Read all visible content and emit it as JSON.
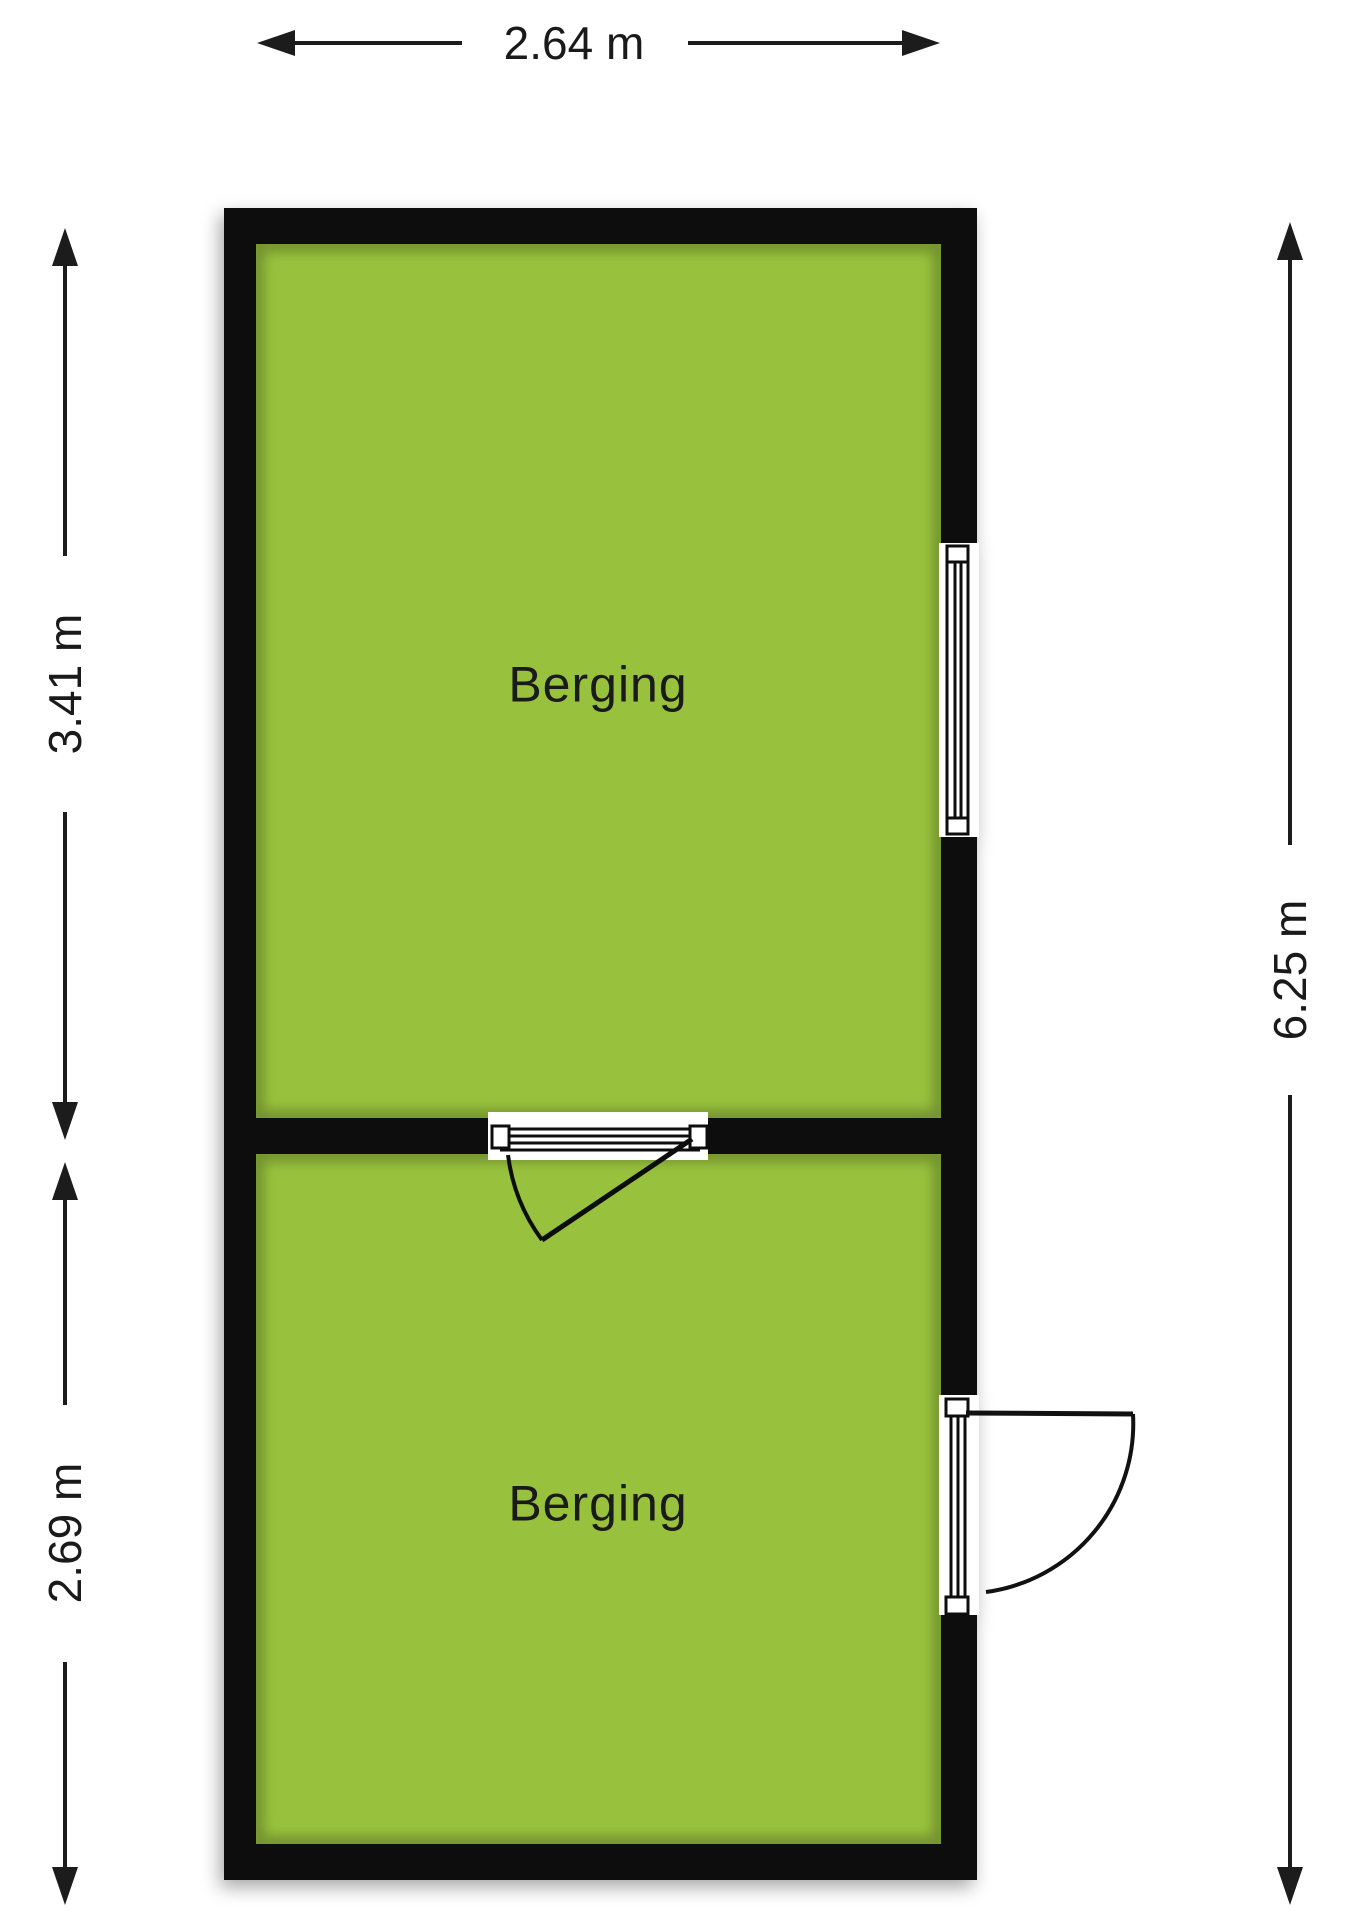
{
  "floorplan": {
    "rooms": [
      {
        "label": "Berging"
      },
      {
        "label": "Berging"
      }
    ],
    "dimensions": {
      "top_width": "2.64 m",
      "left_room1_height": "3.41 m",
      "left_room2_height": "2.69 m",
      "right_total_height": "6.25 m"
    },
    "symbols": {
      "window": "window-symbol",
      "interior_door": "door-swing-symbol",
      "exterior_door": "door-swing-symbol"
    },
    "colors": {
      "room_fill": "#98c23d",
      "wall": "#0a0a0a",
      "line": "#1c1c1c",
      "background": "#ffffff"
    }
  }
}
